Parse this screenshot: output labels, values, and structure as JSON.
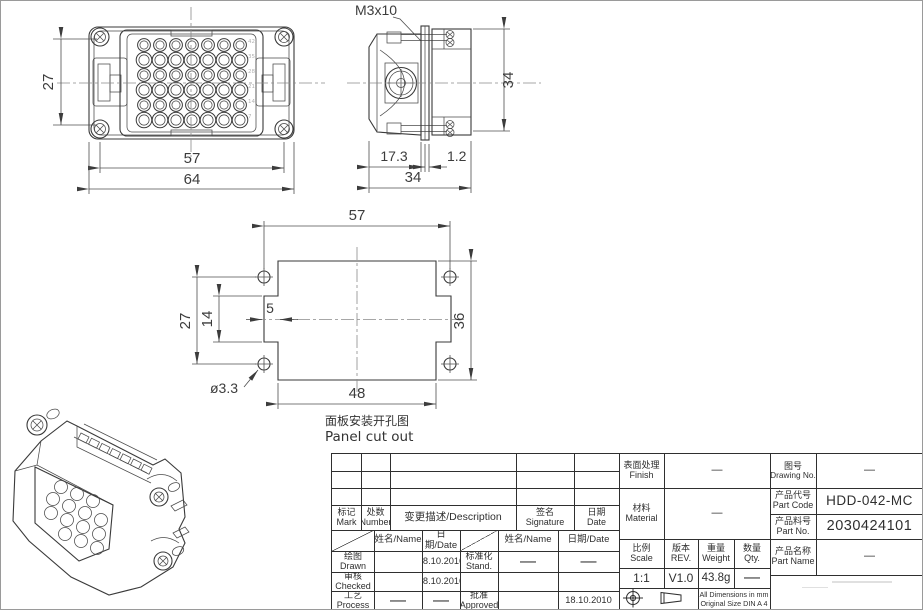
{
  "views": {
    "front": {
      "dim_screw_pitch_v": "27",
      "dim_screw_pitch_h": "57",
      "dim_width": "64",
      "pin_numbers": [
        "42",
        "35",
        "28",
        "21",
        "14",
        "7"
      ]
    },
    "side": {
      "screw_label": "M3x10",
      "dim_depth_front": "17.3",
      "dim_gasket": "1.2",
      "dim_depth_total": "34",
      "dim_height": "34"
    },
    "cutout": {
      "dim_hole_pitch_h": "57",
      "dim_hole_pitch_v": "27",
      "dim_notch_h": "14",
      "dim_notch_depth": "5",
      "dim_hole_dia": "ø3.3",
      "dim_width": "48",
      "dim_height": "36",
      "caption_zh": "面板安装开孔图",
      "caption_en": "Panel cut out"
    }
  },
  "title_block": {
    "headers": {
      "mark_zh": "标记",
      "mark_en": "Mark",
      "number_zh": "处数",
      "number_en": "Number",
      "description": "变更描述/Description",
      "signature_zh": "签名",
      "signature_en": "Signature",
      "date_zh": "日期",
      "date_en": "Date",
      "name_date": {
        "name": "姓名/Name",
        "date": "日期/Date"
      }
    },
    "signoff": {
      "drawn_zh": "绘图",
      "drawn_en": "Drawn",
      "drawn_date": "18.10.2010",
      "checked_zh": "审核",
      "checked_en": "Checked",
      "checked_date": "18.10.2010",
      "process_zh": "工艺",
      "process_en": "Process",
      "process_name": "—",
      "process_date": "—",
      "stand_zh": "标准化",
      "stand_en": "Stand.",
      "stand_name": "—",
      "stand_date": "—",
      "approved_zh": "批准",
      "approved_en": "Approved",
      "approved_date": "18.10.2010"
    },
    "fields": {
      "finish_zh": "表面处理",
      "finish_en": "Finish",
      "finish_value": "—",
      "material_zh": "材料",
      "material_en": "Material",
      "material_value": "—",
      "drawing_no_zh": "图号",
      "drawing_no_en": "Drawing No.",
      "drawing_no_value": "—",
      "part_code_zh": "产品代号",
      "part_code_en": "Part Code",
      "part_code_value": "HDD-042-MC",
      "part_no_zh": "产品料号",
      "part_no_en": "Part No.",
      "part_no_value": "2030424101",
      "part_name_zh": "产品名称",
      "part_name_en": "Part Name",
      "part_name_value": "—",
      "scale_zh": "比例",
      "scale_en": "Scale",
      "scale_value": "1:1",
      "rev_zh": "版本",
      "rev_en": "REV.",
      "rev_value": "V1.0",
      "weight_zh": "重量",
      "weight_en": "Weight",
      "weight_value": "43.8g",
      "qty_zh": "数量",
      "qty_en": "Qty.",
      "qty_value": "—",
      "note_line1": "All Dimensions in mm",
      "note_line2": "Original Size DIN A 4"
    }
  },
  "colors": {
    "line": "#3a3a3a",
    "dim_line": "#4f4f4f",
    "centerline": "#8a8a8a",
    "faint_text": "#b3b3b3",
    "table_line": "#2f2f2f",
    "background": "#ffffff"
  }
}
